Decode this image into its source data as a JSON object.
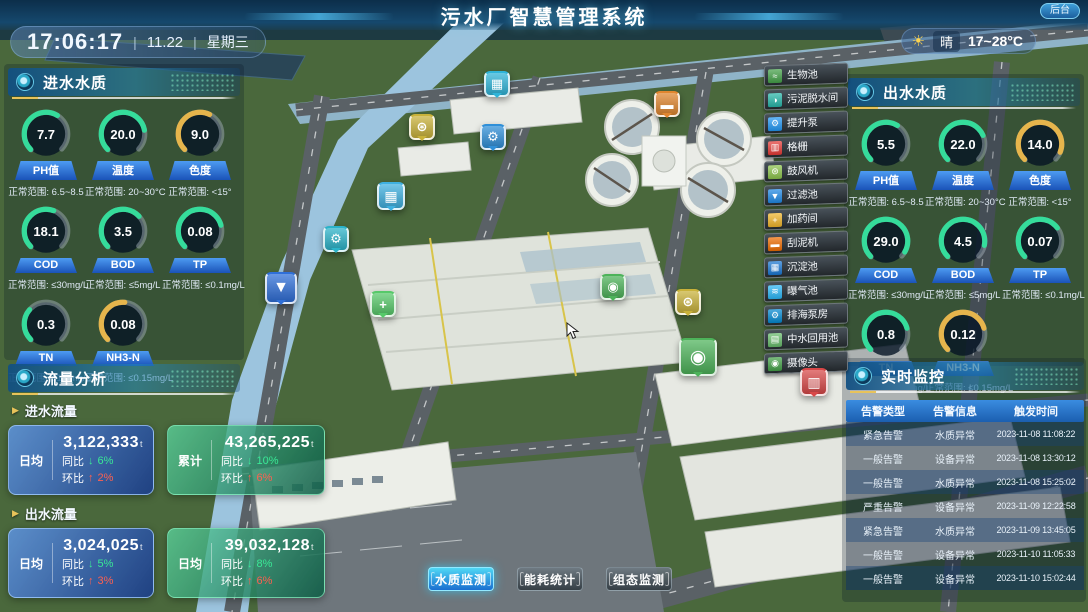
{
  "header": {
    "title": "污水厂智慧管理系统",
    "time": "17:06:17",
    "date": "11.22",
    "weekday": "星期三",
    "weather": {
      "icon": "sun-icon",
      "label": "晴",
      "range": "17~28°C"
    },
    "admin_button": "后台"
  },
  "panels": {
    "inlet": {
      "title": "进水水质",
      "gauges": [
        {
          "label": "PH值",
          "value": "7.7",
          "range": "正常范围: 6.5~8.5",
          "color": "#35dc9b",
          "fraction": 0.62
        },
        {
          "label": "温度",
          "value": "20.0",
          "range": "正常范围: 20~30°C",
          "color": "#35dc9b",
          "fraction": 0.8
        },
        {
          "label": "色度",
          "value": "9.0",
          "range": "正常范围: <15°",
          "color": "#e6b54c",
          "fraction": 0.6
        },
        {
          "label": "COD",
          "value": "18.1",
          "range": "正常范围: ≤30mg/L",
          "color": "#35dc9b",
          "fraction": 0.58
        },
        {
          "label": "BOD",
          "value": "3.5",
          "range": "正常范围: ≤5mg/L",
          "color": "#35dc9b",
          "fraction": 0.68
        },
        {
          "label": "TP",
          "value": "0.08",
          "range": "正常范围: ≤0.1mg/L",
          "color": "#35dc9b",
          "fraction": 0.78
        },
        {
          "label": "TN",
          "value": "0.3",
          "range": "正常范围: ≤1.0mg/L",
          "color": "#35dc9b",
          "fraction": 0.32
        },
        {
          "label": "NH3-N",
          "value": "0.08",
          "range": "正常范围: ≤0.15mg/L",
          "color": "#e6b54c",
          "fraction": 0.52
        }
      ]
    },
    "outlet": {
      "title": "出水水质",
      "gauges": [
        {
          "label": "PH值",
          "value": "5.5",
          "range": "正常范围: 6.5~8.5",
          "color": "#35dc9b",
          "fraction": 0.62
        },
        {
          "label": "温度",
          "value": "22.0",
          "range": "正常范围: 20~30°C",
          "color": "#35dc9b",
          "fraction": 0.75
        },
        {
          "label": "色度",
          "value": "14.0",
          "range": "正常范围: <15°",
          "color": "#e6b54c",
          "fraction": 0.92
        },
        {
          "label": "COD",
          "value": "29.0",
          "range": "正常范围: ≤30mg/L",
          "color": "#35dc9b",
          "fraction": 0.95
        },
        {
          "label": "BOD",
          "value": "4.5",
          "range": "正常范围: ≤5mg/L",
          "color": "#35dc9b",
          "fraction": 0.88
        },
        {
          "label": "TP",
          "value": "0.07",
          "range": "正常范围: ≤0.1mg/L",
          "color": "#35dc9b",
          "fraction": 0.7
        },
        {
          "label": "TN",
          "value": "0.8",
          "range": "正常范围: ≤1.0mg/L",
          "color": "#35dc9b",
          "fraction": 0.78
        },
        {
          "label": "NH3-N",
          "value": "0.12",
          "range": "正常范围: ≤0.15mg/L",
          "color": "#e6b54c",
          "fraction": 0.78
        }
      ]
    },
    "flow": {
      "title": "流量分析",
      "yoy_label": "同比",
      "mom_label": "环比",
      "groups": [
        {
          "label": "进水流量",
          "cards": [
            {
              "tone": "blue",
              "stat": "日均",
              "value": "3,122,333",
              "unit": "t",
              "yoy": "6%",
              "mom": "2%"
            },
            {
              "tone": "green",
              "stat": "累计",
              "value": "43,265,225",
              "unit": "t",
              "yoy": "10%",
              "mom": "6%"
            }
          ]
        },
        {
          "label": "出水流量",
          "cards": [
            {
              "tone": "blue",
              "stat": "日均",
              "value": "3,024,025",
              "unit": "t",
              "yoy": "5%",
              "mom": "3%"
            },
            {
              "tone": "green",
              "stat": "日均",
              "value": "39,032,128",
              "unit": "t",
              "yoy": "8%",
              "mom": "6%"
            }
          ]
        }
      ]
    },
    "monitor": {
      "title": "实时监控",
      "columns": [
        "告警类型",
        "告警信息",
        "触发时间"
      ],
      "rows": [
        [
          "紧急告警",
          "水质异常",
          "2023-11-08 11:08:22"
        ],
        [
          "一般告警",
          "设备异常",
          "2023-11-08 13:30:12"
        ],
        [
          "一般告警",
          "水质异常",
          "2023-11-08 15:25:02"
        ],
        [
          "严重告警",
          "设备异常",
          "2023-11-09 12:22:58"
        ],
        [
          "紧急告警",
          "水质异常",
          "2023-11-09 13:45:05"
        ],
        [
          "一般告警",
          "设备异常",
          "2023-11-10 11:05:33"
        ],
        [
          "一般告警",
          "设备异常",
          "2023-11-10 15:02:44"
        ]
      ]
    }
  },
  "scene": {
    "legend": [
      {
        "label": "生物池",
        "icon": "bio-pool-icon",
        "glyph": "≈",
        "color": "#43a047"
      },
      {
        "label": "污泥脱水间",
        "icon": "sludge-dewatering-icon",
        "glyph": "◑",
        "color": "#26b5a8"
      },
      {
        "label": "提升泵",
        "icon": "lift-pump-icon",
        "glyph": "⚙",
        "color": "#2196f3"
      },
      {
        "label": "格栅",
        "icon": "grille-icon",
        "glyph": "▥",
        "color": "#e53935"
      },
      {
        "label": "鼓风机",
        "icon": "blower-icon",
        "glyph": "⊛",
        "color": "#8bc34a"
      },
      {
        "label": "过滤池",
        "icon": "filter-pool-icon",
        "glyph": "▼",
        "color": "#1e88e5"
      },
      {
        "label": "加药间",
        "icon": "dosing-room-icon",
        "glyph": "+",
        "color": "#f0b429"
      },
      {
        "label": "刮泥机",
        "icon": "scraper-icon",
        "glyph": "▬",
        "color": "#ef6c00"
      },
      {
        "label": "沉淀池",
        "icon": "sedimentation-pool-icon",
        "glyph": "▦",
        "color": "#1976d2"
      },
      {
        "label": "曝气池",
        "icon": "aeration-pool-icon",
        "glyph": "≋",
        "color": "#29b6f6"
      },
      {
        "label": "排海泵房",
        "icon": "sea-pump-house-icon",
        "glyph": "⚙",
        "color": "#0288d1"
      },
      {
        "label": "中水回用池",
        "icon": "water-reuse-pool-icon",
        "glyph": "▤",
        "color": "#66bb6a"
      },
      {
        "label": "摄像头",
        "icon": "camera-icon",
        "glyph": "◉",
        "color": "#43a047"
      }
    ],
    "markers": [
      {
        "name": "sedimentation-marker",
        "glyph": "▦",
        "color": "#2fb4d8",
        "x": 497,
        "y": 84,
        "size": 26
      },
      {
        "name": "blower-marker-1",
        "glyph": "⊛",
        "color": "#c9b23a",
        "x": 422,
        "y": 127,
        "size": 26
      },
      {
        "name": "pump-marker-1",
        "glyph": "⚙",
        "color": "#2f8fd8",
        "x": 493,
        "y": 137,
        "size": 26
      },
      {
        "name": "scraper-marker",
        "glyph": "▬",
        "color": "#e0862f",
        "x": 667,
        "y": 104,
        "size": 26
      },
      {
        "name": "aeration-marker",
        "glyph": "▦",
        "color": "#3fb0e0",
        "x": 391,
        "y": 196,
        "size": 28
      },
      {
        "name": "pump-marker-2",
        "glyph": "⚙",
        "color": "#2bb3c9",
        "x": 336,
        "y": 239,
        "size": 26
      },
      {
        "name": "filter-marker",
        "glyph": "▼",
        "color": "#2f6fd8",
        "x": 281,
        "y": 288,
        "size": 32
      },
      {
        "name": "dosing-marker",
        "glyph": "+",
        "color": "#57c96a",
        "x": 383,
        "y": 304,
        "size": 26
      },
      {
        "name": "camera-marker-1",
        "glyph": "◉",
        "color": "#4db35a",
        "x": 613,
        "y": 287,
        "size": 26
      },
      {
        "name": "blower-marker-2",
        "glyph": "⊛",
        "color": "#c9b23a",
        "x": 688,
        "y": 302,
        "size": 26
      },
      {
        "name": "camera-marker-2",
        "glyph": "◉",
        "color": "#4db35a",
        "x": 698,
        "y": 357,
        "size": 38
      },
      {
        "name": "grille-marker",
        "glyph": "▥",
        "color": "#d84848",
        "x": 814,
        "y": 382,
        "size": 28
      }
    ]
  },
  "footer": {
    "buttons": [
      {
        "label": "水质监测",
        "active": true
      },
      {
        "label": "能耗统计",
        "active": false
      },
      {
        "label": "组态监测",
        "active": false
      }
    ]
  }
}
